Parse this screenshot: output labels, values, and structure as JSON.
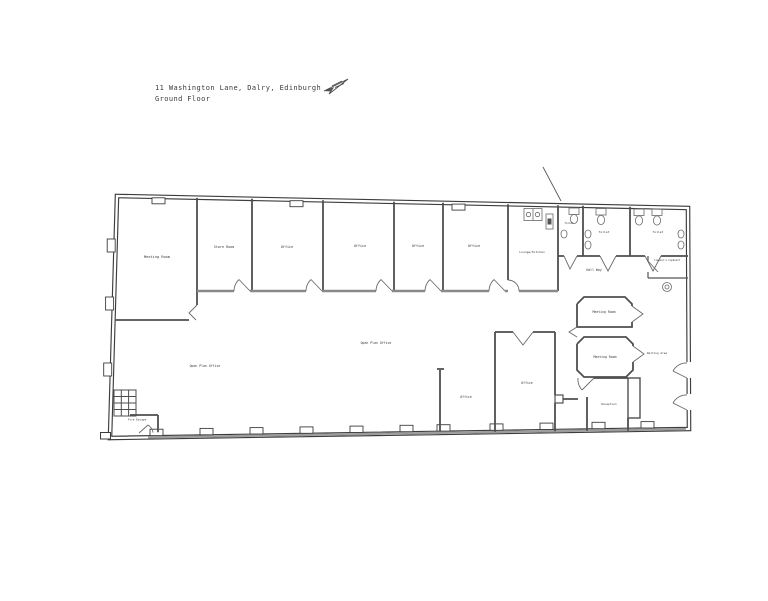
{
  "title": {
    "address": "11 Washington Lane, Dalry, Edinburgh",
    "floor": "Ground Floor"
  },
  "icons": {
    "north_arrow": "sketched-direction-arrow",
    "leader_line": "diagonal-leader-line"
  },
  "colors": {
    "background": "#ffffff",
    "outer_wall": "#3d3d3d",
    "inner_wall": "#4f4f4f",
    "partition_grey": "#8a8a8a",
    "window_band": "#9c9c9c",
    "label_text": "#3a3a3a"
  },
  "rooms": {
    "meeting_room_west": "Meeting Room",
    "store_room": "Store Room",
    "office_a": "Office",
    "office_b": "Office",
    "office_c": "Office",
    "office_d": "Office",
    "lounge_kitchen": "Lounge/Kitchen",
    "toilet_a": "Toilet",
    "toilet_b": "Toilet",
    "toilet_c": "Toilet",
    "hall_way": "Hall Way",
    "cleaners_cupboard": "Cleaner's Cupboard",
    "meeting_room_a": "Meeting Room",
    "meeting_room_b": "Meeting Room",
    "waiting_area": "Waiting Area",
    "reception": "Reception",
    "office_e": "Office",
    "office_f": "Office",
    "open_plan_office_a": "Open Plan Office",
    "open_plan_office_b": "Open Plan Office",
    "fire_escape": "Fire Escape"
  }
}
